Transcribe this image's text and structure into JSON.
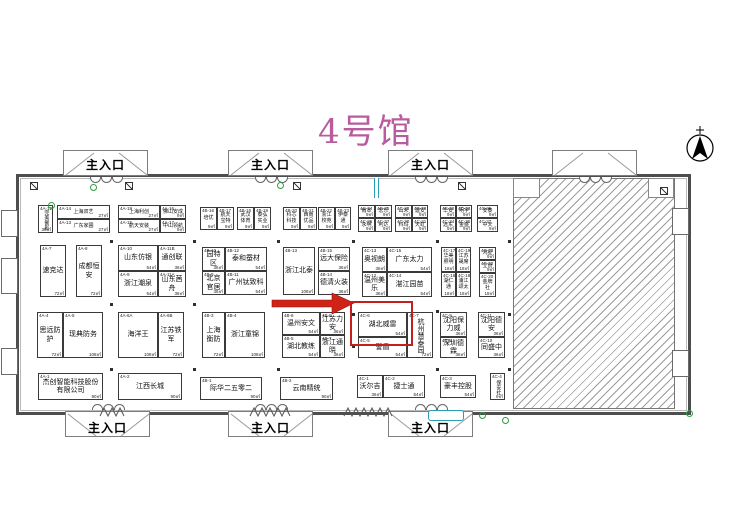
{
  "title": {
    "text": "4号馆",
    "color": "#b85c9e"
  },
  "entrance_label": "主入口",
  "entrances": {
    "top": [
      {
        "x": 63,
        "labeled": true
      },
      {
        "x": 228,
        "labeled": true
      },
      {
        "x": 388,
        "labeled": true
      },
      {
        "x": 552,
        "labeled": false
      }
    ],
    "bottom": [
      {
        "x": 65,
        "labeled": true
      },
      {
        "x": 228,
        "labeled": true
      },
      {
        "x": 388,
        "labeled": true
      }
    ]
  },
  "annotation": {
    "arrow_color": "#d02318",
    "box_color": "#c41f1f",
    "target_booth": "4C-6",
    "box": {
      "x": 350,
      "y": 301,
      "w": 59,
      "h": 41
    },
    "arrow": {
      "x": 270,
      "y": 291,
      "w": 84,
      "h": 26
    }
  },
  "compass": {
    "type": "north-arrow"
  },
  "booths": [
    {
      "id": "4A-12",
      "name": "完美餐影",
      "area": "36㎡",
      "x": 38,
      "y": 205,
      "w": 15,
      "h": 28,
      "cls": "v s"
    },
    {
      "id": "4A-14",
      "name": "上海双艺",
      "area": "27㎡",
      "x": 57,
      "y": 205,
      "w": 53,
      "h": 14,
      "cls": "s"
    },
    {
      "id": "4A-13",
      "name": "广东家圃",
      "area": "27㎡",
      "x": 57,
      "y": 219,
      "w": 53,
      "h": 14,
      "cls": "s"
    },
    {
      "id": "4A-18",
      "name": "上海利创",
      "area": "27㎡",
      "x": 118,
      "y": 205,
      "w": 42,
      "h": 14,
      "cls": "s"
    },
    {
      "id": "4A-15",
      "name": "航天安装",
      "area": "27㎡",
      "x": 118,
      "y": 219,
      "w": 42,
      "h": 14,
      "cls": "s"
    },
    {
      "id": "4A-16",
      "name": "佛山安成",
      "area": "9㎡",
      "x": 160,
      "y": 205,
      "w": 26,
      "h": 14,
      "cls": "s"
    },
    {
      "id": "4A-17",
      "name": "中山领航",
      "area": "9㎡",
      "x": 160,
      "y": 219,
      "w": 26,
      "h": 14,
      "cls": "s"
    },
    {
      "id": "4A-7",
      "name": "速克达",
      "area": "72㎡",
      "x": 40,
      "y": 245,
      "w": 26,
      "h": 52,
      "cls": ""
    },
    {
      "id": "4A-8",
      "name": "成都恒安",
      "area": "72㎡",
      "x": 76,
      "y": 245,
      "w": 26,
      "h": 52,
      "cls": ""
    },
    {
      "id": "4A-10",
      "name": "山东仿银",
      "area": "54㎡",
      "x": 118,
      "y": 245,
      "w": 40,
      "h": 26,
      "cls": ""
    },
    {
      "id": "4A-11B",
      "name": "通创联",
      "area": "36㎡",
      "x": 158,
      "y": 245,
      "w": 28,
      "h": 26,
      "cls": ""
    },
    {
      "id": "4A-9",
      "name": "浙江潮泉",
      "area": "54㎡",
      "x": 118,
      "y": 271,
      "w": 40,
      "h": 26,
      "cls": ""
    },
    {
      "id": "4A-11A",
      "name": "山东茜舟",
      "area": "36㎡",
      "x": 158,
      "y": 271,
      "w": 28,
      "h": 26,
      "cls": ""
    },
    {
      "id": "4A-4",
      "name": "思远防护",
      "area": "72㎡",
      "x": 37,
      "y": 312,
      "w": 26,
      "h": 46,
      "cls": ""
    },
    {
      "id": "4A-5",
      "name": "现典防务",
      "area": "108㎡",
      "x": 63,
      "y": 312,
      "w": 40,
      "h": 46,
      "cls": ""
    },
    {
      "id": "4A-6A",
      "name": "海洋王",
      "area": "108㎡",
      "x": 118,
      "y": 312,
      "w": 40,
      "h": 46,
      "cls": ""
    },
    {
      "id": "4A-6B",
      "name": "江苏铁军",
      "area": "72㎡",
      "x": 158,
      "y": 312,
      "w": 26,
      "h": 46,
      "cls": ""
    },
    {
      "id": "4A-1",
      "name": "杰创智能科技股份有限公司",
      "area": "90㎡",
      "x": 38,
      "y": 373,
      "w": 65,
      "h": 27,
      "cls": ""
    },
    {
      "id": "4A-2",
      "name": "江西长城",
      "area": "90㎡",
      "x": 118,
      "y": 373,
      "w": 64,
      "h": 27,
      "cls": ""
    },
    {
      "id": "4B-16",
      "name": "培优",
      "area": "9㎡",
      "x": 200,
      "y": 207,
      "w": 17,
      "h": 23,
      "cls": "s"
    },
    {
      "id": "4B-17",
      "name": "航天宝特",
      "area": "9㎡",
      "x": 217,
      "y": 207,
      "w": 17,
      "h": 23,
      "cls": "s"
    },
    {
      "id": "4B-18",
      "name": "武汉体育",
      "area": "9㎡",
      "x": 237,
      "y": 207,
      "w": 17,
      "h": 23,
      "cls": "s"
    },
    {
      "id": "4B-19",
      "name": "泰弘实业",
      "area": "9㎡",
      "x": 254,
      "y": 207,
      "w": 17,
      "h": 23,
      "cls": "s"
    },
    {
      "id": "4B-20",
      "name": "科芯科技",
      "area": "9㎡",
      "x": 283,
      "y": 207,
      "w": 17,
      "h": 23,
      "cls": "s"
    },
    {
      "id": "4B-21",
      "name": "西南优品",
      "area": "9㎡",
      "x": 300,
      "y": 207,
      "w": 17,
      "h": 23,
      "cls": "s"
    },
    {
      "id": "4B-22",
      "name": "浙江校苑",
      "area": "9㎡",
      "x": 318,
      "y": 207,
      "w": 17,
      "h": 23,
      "cls": "s"
    },
    {
      "id": "4B-23",
      "name": "伊泰通",
      "area": "9㎡",
      "x": 335,
      "y": 207,
      "w": 16,
      "h": 23,
      "cls": "s"
    },
    {
      "id": "4B-10",
      "name": "园特区",
      "area": "36㎡",
      "x": 202,
      "y": 247,
      "w": 23,
      "h": 24,
      "cls": ""
    },
    {
      "id": "4B-12",
      "name": "泰和蚕材",
      "area": "54㎡",
      "x": 225,
      "y": 247,
      "w": 42,
      "h": 24,
      "cls": ""
    },
    {
      "id": "4B-9",
      "name": "北京官居",
      "area": "36㎡",
      "x": 202,
      "y": 271,
      "w": 23,
      "h": 24,
      "cls": ""
    },
    {
      "id": "4B-11",
      "name": "广州钛致科",
      "area": "54㎡",
      "x": 225,
      "y": 271,
      "w": 42,
      "h": 24,
      "cls": ""
    },
    {
      "id": "4B-13",
      "name": "浙江北泰",
      "area": "108㎡",
      "x": 283,
      "y": 247,
      "w": 32,
      "h": 48,
      "cls": ""
    },
    {
      "id": "4B-15",
      "name": "远大保险",
      "area": "36㎡",
      "x": 318,
      "y": 247,
      "w": 32,
      "h": 24,
      "cls": ""
    },
    {
      "id": "4B-14",
      "name": "德清火装",
      "area": "36㎡",
      "x": 318,
      "y": 271,
      "w": 32,
      "h": 24,
      "cls": ""
    },
    {
      "id": "4B-3",
      "name": "上海衡防",
      "area": "72㎡",
      "x": 202,
      "y": 312,
      "w": 23,
      "h": 46,
      "cls": ""
    },
    {
      "id": "4B-4",
      "name": "浙江童锦",
      "area": "108㎡",
      "x": 225,
      "y": 312,
      "w": 40,
      "h": 46,
      "cls": ""
    },
    {
      "id": "4B-6",
      "name": "温州安文",
      "area": "54㎡",
      "x": 282,
      "y": 312,
      "w": 38,
      "h": 23,
      "cls": ""
    },
    {
      "id": "4B-8",
      "name": "江苏力安",
      "area": "36㎡",
      "x": 320,
      "y": 312,
      "w": 25,
      "h": 23,
      "cls": ""
    },
    {
      "id": "4B-5",
      "name": "湖北教练",
      "area": "54㎡",
      "x": 282,
      "y": 335,
      "w": 38,
      "h": 23,
      "cls": ""
    },
    {
      "id": "4B-7",
      "name": "浙江通晓",
      "area": "36㎡",
      "x": 320,
      "y": 335,
      "w": 25,
      "h": 23,
      "cls": ""
    },
    {
      "id": "4B-1",
      "name": "际华二五零二",
      "area": "90㎡",
      "x": 200,
      "y": 377,
      "w": 62,
      "h": 23,
      "cls": ""
    },
    {
      "id": "4B-2",
      "name": "云南精统",
      "area": "90㎡",
      "x": 280,
      "y": 377,
      "w": 53,
      "h": 23,
      "cls": ""
    },
    {
      "id": "4C-24",
      "name": "雨本",
      "area": "9㎡",
      "x": 358,
      "y": 205,
      "w": 17,
      "h": 13,
      "cls": "s"
    },
    {
      "id": "4C-25",
      "name": "宏乐",
      "area": "9㎡",
      "x": 375,
      "y": 205,
      "w": 17,
      "h": 13,
      "cls": "s"
    },
    {
      "id": "4C-26",
      "name": "永明",
      "area": "9㎡",
      "x": 358,
      "y": 218,
      "w": 17,
      "h": 14,
      "cls": "s"
    },
    {
      "id": "4C-27",
      "name": "利达",
      "area": "9㎡",
      "x": 375,
      "y": 218,
      "w": 17,
      "h": 14,
      "cls": "s"
    },
    {
      "id": "4C-28",
      "name": "山禾",
      "area": "9㎡",
      "x": 395,
      "y": 205,
      "w": 17,
      "h": 13,
      "cls": "s"
    },
    {
      "id": "4C-29",
      "name": "建安",
      "area": "9㎡",
      "x": 412,
      "y": 205,
      "w": 16,
      "h": 13,
      "cls": "s"
    },
    {
      "id": "4C-30",
      "name": "科玛",
      "area": "9㎡",
      "x": 395,
      "y": 218,
      "w": 17,
      "h": 14,
      "cls": "s"
    },
    {
      "id": "4C-31",
      "name": "天虹",
      "area": "9㎡",
      "x": 412,
      "y": 218,
      "w": 16,
      "h": 14,
      "cls": "s"
    },
    {
      "id": "4C-32",
      "name": "华安",
      "area": "9㎡",
      "x": 440,
      "y": 205,
      "w": 16,
      "h": 13,
      "cls": "s"
    },
    {
      "id": "4C-33",
      "name": "明宇",
      "area": "9㎡",
      "x": 456,
      "y": 205,
      "w": 16,
      "h": 13,
      "cls": "s"
    },
    {
      "id": "4C-34",
      "name": "远东",
      "area": "9㎡",
      "x": 440,
      "y": 218,
      "w": 16,
      "h": 14,
      "cls": "s"
    },
    {
      "id": "4C-35",
      "name": "金盛",
      "area": "9㎡",
      "x": 456,
      "y": 218,
      "w": 16,
      "h": 14,
      "cls": "s"
    },
    {
      "id": "4C-36",
      "name": "安泰",
      "area": "9㎡",
      "x": 477,
      "y": 205,
      "w": 21,
      "h": 13,
      "cls": "s"
    },
    {
      "id": "4C-37",
      "name": "中天",
      "area": "9㎡",
      "x": 477,
      "y": 218,
      "w": 21,
      "h": 14,
      "cls": "s"
    },
    {
      "id": "4C-13",
      "name": "奥视朗",
      "area": "36㎡",
      "x": 362,
      "y": 247,
      "w": 25,
      "h": 25,
      "cls": ""
    },
    {
      "id": "4C-15",
      "name": "广东太力",
      "area": "54㎡",
      "x": 387,
      "y": 247,
      "w": 45,
      "h": 25,
      "cls": ""
    },
    {
      "id": "4C-12",
      "name": "温州美乐",
      "area": "36㎡",
      "x": 362,
      "y": 272,
      "w": 25,
      "h": 25,
      "cls": ""
    },
    {
      "id": "4C-14",
      "name": "湛江园苗",
      "area": "54㎡",
      "x": 387,
      "y": 272,
      "w": 45,
      "h": 25,
      "cls": ""
    },
    {
      "id": "4C-17",
      "name": "华美照明",
      "area": "18㎡",
      "x": 441,
      "y": 247,
      "w": 15,
      "h": 25,
      "cls": "s"
    },
    {
      "id": "4C-19",
      "name": "江苏晟席",
      "area": "18㎡",
      "x": 456,
      "y": 247,
      "w": 15,
      "h": 25,
      "cls": "s"
    },
    {
      "id": "4C-16",
      "name": "湖仁通",
      "area": "18㎡",
      "x": 441,
      "y": 272,
      "w": 15,
      "h": 25,
      "cls": "s"
    },
    {
      "id": "4C-18",
      "name": "浦江颂太",
      "area": "18㎡",
      "x": 456,
      "y": 272,
      "w": 15,
      "h": 25,
      "cls": "s"
    },
    {
      "id": "4C-23",
      "name": "鸿星",
      "area": "9㎡",
      "x": 479,
      "y": 247,
      "w": 17,
      "h": 13,
      "cls": "s"
    },
    {
      "id": "4C-22",
      "name": "立创",
      "area": "9㎡",
      "x": 479,
      "y": 260,
      "w": 17,
      "h": 13,
      "cls": "s"
    },
    {
      "id": "4C-20",
      "name": "金牌社",
      "area": "18㎡",
      "x": 479,
      "y": 273,
      "w": 17,
      "h": 24,
      "cls": "s"
    },
    {
      "id": "4C-6",
      "name": "湖北威雷",
      "area": "54㎡",
      "x": 358,
      "y": 312,
      "w": 49,
      "h": 25,
      "cls": ""
    },
    {
      "id": "4C-5",
      "name": "警盾",
      "area": "54㎡",
      "x": 358,
      "y": 337,
      "w": 49,
      "h": 21,
      "cls": ""
    },
    {
      "id": "4C-7",
      "name": "杭州慧泰园",
      "area": "72㎡",
      "x": 407,
      "y": 312,
      "w": 26,
      "h": 46,
      "cls": "v"
    },
    {
      "id": "4C-9",
      "name": "沈阳保力威",
      "area": "36㎡",
      "x": 440,
      "y": 312,
      "w": 27,
      "h": 25,
      "cls": ""
    },
    {
      "id": "4C-8",
      "name": "深圳德霖",
      "area": "36㎡",
      "x": 440,
      "y": 337,
      "w": 27,
      "h": 21,
      "cls": ""
    },
    {
      "id": "4C-11",
      "name": "沈阳德安",
      "area": "36㎡",
      "x": 478,
      "y": 312,
      "w": 27,
      "h": 25,
      "cls": ""
    },
    {
      "id": "4C-10",
      "name": "同盛中",
      "area": "36㎡",
      "x": 478,
      "y": 337,
      "w": 27,
      "h": 21,
      "cls": ""
    },
    {
      "id": "4C-1",
      "name": "沃尔吉",
      "area": "36㎡",
      "x": 357,
      "y": 375,
      "w": 26,
      "h": 23,
      "cls": ""
    },
    {
      "id": "4C-2",
      "name": "捷士通",
      "area": "54㎡",
      "x": 383,
      "y": 375,
      "w": 42,
      "h": 23,
      "cls": ""
    },
    {
      "id": "4C-3",
      "name": "豪丰控股",
      "area": "54㎡",
      "x": 440,
      "y": 375,
      "w": 36,
      "h": 23,
      "cls": ""
    },
    {
      "id": "4C-4",
      "name": "保安社",
      "area": "9㎡",
      "x": 490,
      "y": 373,
      "w": 15,
      "h": 27,
      "cls": "v s"
    }
  ]
}
